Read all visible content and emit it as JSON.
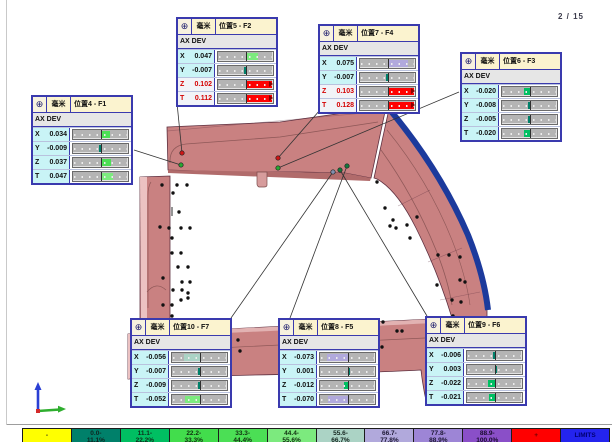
{
  "page": {
    "indicator": "2 / 15"
  },
  "callout_common": {
    "unit": "毫米",
    "table_header": "AX DEV",
    "target_icon": "⊕"
  },
  "callouts": [
    {
      "id": "pos4",
      "title": "位置4 - F1",
      "x": 31,
      "y": 95,
      "rows": [
        {
          "axis": "X",
          "value": "0.034",
          "pct": 34,
          "dir": 1,
          "color": "#4bdf55",
          "oot": false
        },
        {
          "axis": "Y",
          "value": "-0.009",
          "pct": 9,
          "dir": -1,
          "color": "#00806a",
          "oot": false
        },
        {
          "axis": "Z",
          "value": "0.037",
          "pct": 37,
          "dir": 1,
          "color": "#4bdf55",
          "oot": false
        },
        {
          "axis": "T",
          "value": "0.047",
          "pct": 47,
          "dir": 1,
          "color": "#7cea7e",
          "oot": false
        }
      ],
      "leader": {
        "x1": 134,
        "y1": 150,
        "x2": 181,
        "y2": 165
      }
    },
    {
      "id": "pos5",
      "title": "位置5 - F2",
      "x": 176,
      "y": 17,
      "rows": [
        {
          "axis": "X",
          "value": "0.047",
          "pct": 47,
          "dir": 1,
          "color": "#7cea7e",
          "oot": false
        },
        {
          "axis": "Y",
          "value": "-0.007",
          "pct": 7,
          "dir": -1,
          "color": "#00806a",
          "oot": false
        },
        {
          "axis": "Z",
          "value": "0.102",
          "pct": 100,
          "dir": 1,
          "color": "#fe0202",
          "oot": true
        },
        {
          "axis": "T",
          "value": "0.112",
          "pct": 100,
          "dir": 1,
          "color": "#fe0202",
          "oot": true
        }
      ],
      "leader": {
        "x1": 177,
        "y1": 103,
        "x2": 182,
        "y2": 153
      }
    },
    {
      "id": "pos7",
      "title": "位置7 - F4",
      "x": 318,
      "y": 24,
      "rows": [
        {
          "axis": "X",
          "value": "0.075",
          "pct": 75,
          "dir": 1,
          "color": "#b1a9dc",
          "oot": false
        },
        {
          "axis": "Y",
          "value": "-0.007",
          "pct": 7,
          "dir": -1,
          "color": "#00806a",
          "oot": false
        },
        {
          "axis": "Z",
          "value": "0.103",
          "pct": 100,
          "dir": 1,
          "color": "#fe0202",
          "oot": true
        },
        {
          "axis": "T",
          "value": "0.128",
          "pct": 100,
          "dir": 1,
          "color": "#fe0202",
          "oot": true
        }
      ],
      "leader": {
        "x1": 320,
        "y1": 110,
        "x2": 278,
        "y2": 158
      }
    },
    {
      "id": "pos6",
      "title": "位置6 - F3",
      "x": 460,
      "y": 52,
      "rows": [
        {
          "axis": "X",
          "value": "-0.020",
          "pct": 20,
          "dir": -1,
          "color": "#00bf62",
          "oot": false
        },
        {
          "axis": "Y",
          "value": "-0.008",
          "pct": 8,
          "dir": -1,
          "color": "#00806a",
          "oot": false
        },
        {
          "axis": "Z",
          "value": "-0.005",
          "pct": 5,
          "dir": -1,
          "color": "#00806a",
          "oot": false
        },
        {
          "axis": "T",
          "value": "-0.020",
          "pct": 20,
          "dir": -1,
          "color": "#00bf62",
          "oot": false
        }
      ],
      "leader": {
        "x1": 459,
        "y1": 92,
        "x2": 278,
        "y2": 168
      }
    },
    {
      "id": "pos10",
      "title": "位置10 - F7",
      "x": 130,
      "y": 318,
      "rows": [
        {
          "axis": "X",
          "value": "-0.056",
          "pct": 56,
          "dir": -1,
          "color": "#abd3c5",
          "oot": false
        },
        {
          "axis": "Y",
          "value": "-0.007",
          "pct": 7,
          "dir": -1,
          "color": "#00806a",
          "oot": false
        },
        {
          "axis": "Z",
          "value": "-0.009",
          "pct": 9,
          "dir": -1,
          "color": "#00806a",
          "oot": false
        },
        {
          "axis": "T",
          "value": "-0.052",
          "pct": 52,
          "dir": -1,
          "color": "#7cea7e",
          "oot": false
        }
      ],
      "leader": {
        "x1": 231,
        "y1": 318,
        "x2": 333,
        "y2": 172
      }
    },
    {
      "id": "pos8",
      "title": "位置8 - F5",
      "x": 278,
      "y": 318,
      "rows": [
        {
          "axis": "X",
          "value": "-0.073",
          "pct": 73,
          "dir": -1,
          "color": "#b1a9dc",
          "oot": false
        },
        {
          "axis": "Y",
          "value": "0.001",
          "pct": 1,
          "dir": 1,
          "color": "#00806a",
          "oot": false
        },
        {
          "axis": "Z",
          "value": "-0.012",
          "pct": 12,
          "dir": -1,
          "color": "#00bf62",
          "oot": false
        },
        {
          "axis": "T",
          "value": "-0.070",
          "pct": 70,
          "dir": -1,
          "color": "#b1a9dc",
          "oot": false
        }
      ],
      "leader": {
        "x1": 290,
        "y1": 318,
        "x2": 347,
        "y2": 166
      }
    },
    {
      "id": "pos9",
      "title": "位置9 - F6",
      "x": 425,
      "y": 316,
      "rows": [
        {
          "axis": "X",
          "value": "-0.006",
          "pct": 6,
          "dir": -1,
          "color": "#00806a",
          "oot": false
        },
        {
          "axis": "Y",
          "value": "0.003",
          "pct": 3,
          "dir": 1,
          "color": "#00806a",
          "oot": false
        },
        {
          "axis": "Z",
          "value": "-0.022",
          "pct": 22,
          "dir": -1,
          "color": "#00bf62",
          "oot": false
        },
        {
          "axis": "T",
          "value": "-0.021",
          "pct": 21,
          "dir": -1,
          "color": "#00bf62",
          "oot": false
        }
      ],
      "leader": {
        "x1": 427,
        "y1": 316,
        "x2": 340,
        "y2": 170
      }
    }
  ],
  "legend": {
    "items": [
      {
        "text": "-",
        "bg": "#ffff00",
        "fg": "#202020"
      },
      {
        "text": "0.0-\n11.1%",
        "bg": "#00806a",
        "fg": "#0e2420"
      },
      {
        "text": "11.1-\n22.2%",
        "bg": "#00bf62",
        "fg": "#0e2e1c"
      },
      {
        "text": "22.2-\n33.3%",
        "bg": "#42dd4c",
        "fg": "#103010"
      },
      {
        "text": "33.3-\n44.4%",
        "bg": "#4bdf55",
        "fg": "#103010"
      },
      {
        "text": "44.4-\n55.6%",
        "bg": "#7cea7e",
        "fg": "#103010"
      },
      {
        "text": "55.6-\n66.7%",
        "bg": "#abd3c5",
        "fg": "#15251f"
      },
      {
        "text": "66.7-\n77.8%",
        "bg": "#b1a9dc",
        "fg": "#1c1733"
      },
      {
        "text": "77.8-\n88.9%",
        "bg": "#9d85d6",
        "fg": "#1c1733"
      },
      {
        "text": "88.9-\n100.0%",
        "bg": "#8a4fc8",
        "fg": "#190b2e"
      },
      {
        "text": "+",
        "bg": "#ff0000",
        "fg": "#6a0000"
      },
      {
        "text": "LIMITS",
        "bg": "#2424ee",
        "fg": "#000070"
      }
    ]
  },
  "viewport": {
    "part_color": "#c98181",
    "limit_edge_color": "#1c3a9c",
    "measurement_points": [
      {
        "x": 182,
        "y": 153,
        "color": "#d01515"
      },
      {
        "x": 181,
        "y": 165,
        "color": "#28a832"
      },
      {
        "x": 278,
        "y": 158,
        "color": "#d01515"
      },
      {
        "x": 278,
        "y": 168,
        "color": "#28a832"
      },
      {
        "x": 347,
        "y": 166,
        "color": "#137a3c"
      },
      {
        "x": 340,
        "y": 170,
        "color": "#137a3c"
      },
      {
        "x": 333,
        "y": 172,
        "color": "#8090b0"
      }
    ],
    "surface_points": [
      [
        162,
        185
      ],
      [
        177,
        185
      ],
      [
        187,
        185
      ],
      [
        173,
        193
      ],
      [
        160,
        227
      ],
      [
        169,
        228
      ],
      [
        181,
        228
      ],
      [
        190,
        228
      ],
      [
        172,
        238
      ],
      [
        172,
        253
      ],
      [
        181,
        253
      ],
      [
        163,
        278
      ],
      [
        178,
        267
      ],
      [
        188,
        267
      ],
      [
        182,
        282
      ],
      [
        190,
        282
      ],
      [
        173,
        290
      ],
      [
        182,
        290
      ],
      [
        188,
        293
      ],
      [
        163,
        305
      ],
      [
        172,
        305
      ],
      [
        181,
        300
      ],
      [
        188,
        298
      ],
      [
        172,
        316
      ],
      [
        178,
        320
      ],
      [
        179,
        212
      ],
      [
        377,
        182
      ],
      [
        385,
        208
      ],
      [
        393,
        220
      ],
      [
        390,
        226
      ],
      [
        396,
        228
      ],
      [
        407,
        225
      ],
      [
        417,
        217
      ],
      [
        410,
        238
      ],
      [
        438,
        255
      ],
      [
        449,
        255
      ],
      [
        460,
        257
      ],
      [
        437,
        285
      ],
      [
        460,
        280
      ],
      [
        452,
        300
      ],
      [
        461,
        302
      ],
      [
        465,
        282
      ],
      [
        238,
        340
      ],
      [
        240,
        351
      ],
      [
        378,
        320
      ],
      [
        397,
        331
      ],
      [
        378,
        340
      ],
      [
        382,
        347
      ],
      [
        453,
        316
      ],
      [
        462,
        318
      ],
      [
        383,
        322
      ],
      [
        402,
        331
      ]
    ]
  }
}
